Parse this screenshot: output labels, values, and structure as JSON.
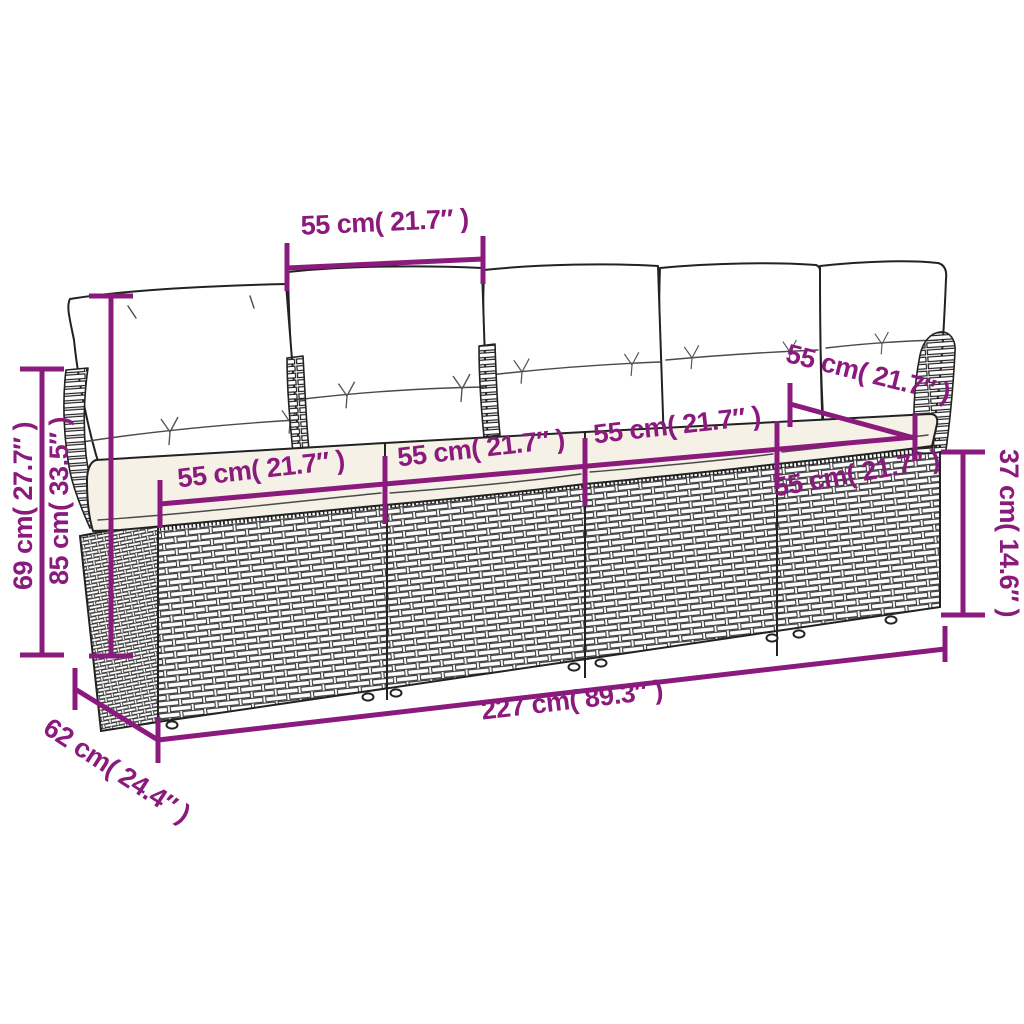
{
  "figure": {
    "type": "product-dimension-diagram",
    "subject": "4-seater rattan garden sofa with back and seat cushions",
    "style": "black line art with magenta dimension annotations on white"
  },
  "colors": {
    "dimension_accent": "#8B1A7D",
    "line_ink": "#222222",
    "seat_cushion_fill": "#f5f1e6",
    "background": "#ffffff"
  },
  "labels": {
    "back_cushion_width_top": "55 cm( 21.7″ )",
    "backrest_height_left_outer": "69 cm( 27.7″ )",
    "total_height_left_inner": "85 cm( 33.5″ )",
    "seat_section_1": "55 cm( 21.7″ )",
    "seat_section_2": "55 cm( 21.7″ )",
    "seat_section_3": "55 cm( 21.7″ )",
    "seat_section_4": "55 cm( 21.7″ )",
    "seat_top_right_diagonal": "55 cm( 21.7″ )",
    "base_height_right": "37 cm( 14.6″ )",
    "total_width_bottom": "227 cm( 89.3″ )",
    "total_depth_bottom_left": "62 cm( 24.4″ )"
  }
}
